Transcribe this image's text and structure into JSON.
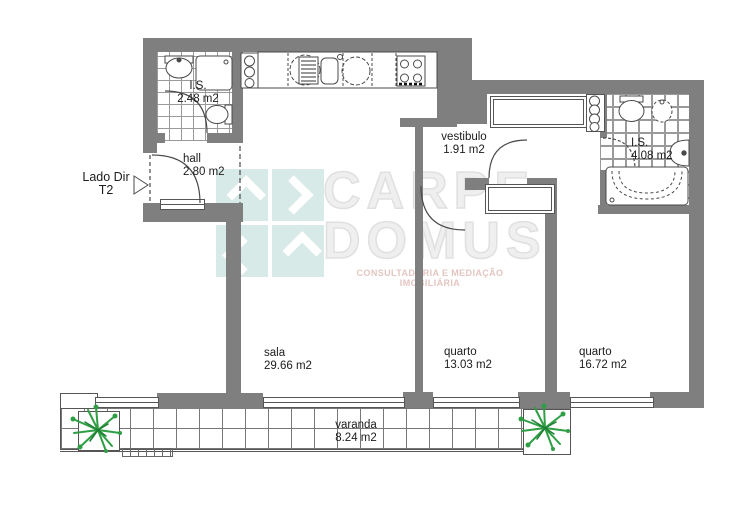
{
  "unit": {
    "label_line1": "Lado Dir",
    "label_line2": "T2"
  },
  "rooms": {
    "is_small": {
      "name": "I.S.",
      "area": "2.48 m2"
    },
    "hall": {
      "name": "hall",
      "area": "2.80 m2"
    },
    "vestibulo": {
      "name": "vestibulo",
      "area": "1.91 m2"
    },
    "is_large": {
      "name": "I.S.",
      "area": "4.08 m2"
    },
    "sala": {
      "name": "sala",
      "area": "29.66 m2"
    },
    "quarto_1": {
      "name": "quarto",
      "area": "13.03 m2"
    },
    "quarto_2": {
      "name": "quarto",
      "area": "16.72 m2"
    },
    "varanda": {
      "name": "varanda",
      "area": "8.24 m2"
    }
  },
  "watermark": {
    "brand_line1": "CARPE",
    "brand_line2": "DOMUS",
    "tagline": "CONSULTADORIA E MEDIAÇÃO IMOBILIÁRIA"
  },
  "colors": {
    "wall": "#7f7f7f",
    "line": "#4a4a4a",
    "tile_line": "#9a9a9a",
    "plant_green": "#2f9e44",
    "plant_green_dark": "#1e7e34",
    "logo_teal": "#d8eae8",
    "watermark_gray": "#e0e0e0",
    "tagline_pink": "#e3c6c1"
  },
  "fixtures": [
    "washbasin",
    "shower",
    "toilet",
    "bidet",
    "bathtub",
    "kitchen-sink",
    "stove",
    "washing-machine",
    "dish-drainer",
    "wardrobe",
    "shelf-column",
    "door-arc",
    "window",
    "plant",
    "planter",
    "orientation-arrow"
  ]
}
